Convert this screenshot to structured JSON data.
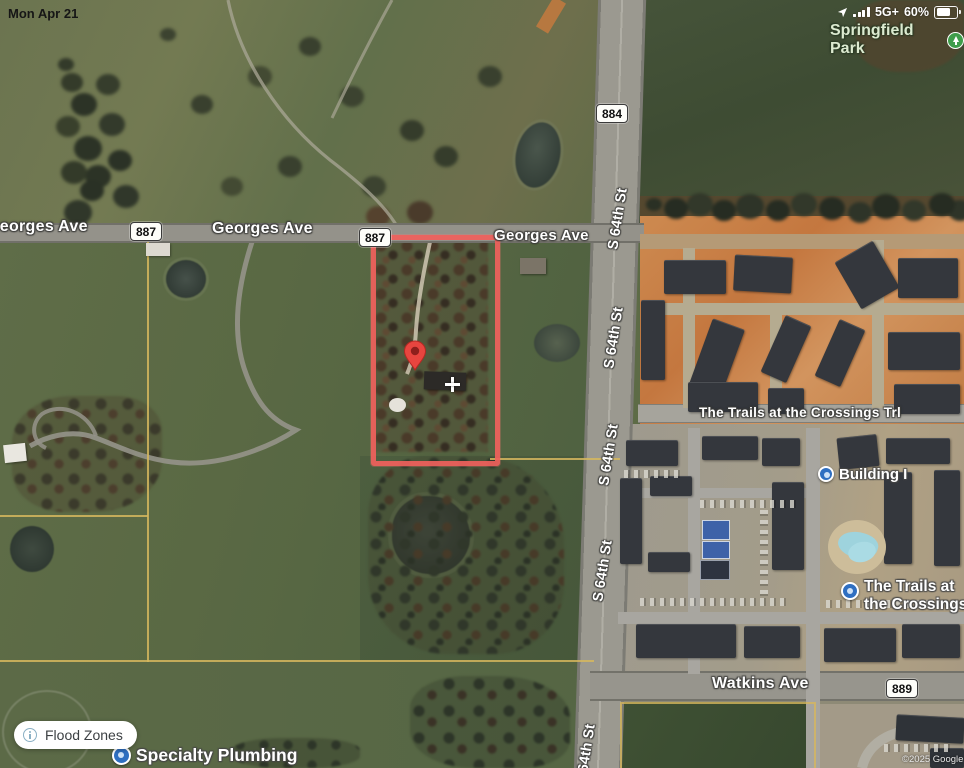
{
  "status_bar": {
    "date": "Mon Apr 21",
    "network": "5G+",
    "battery_percent": "60%"
  },
  "map": {
    "view_type": "satellite",
    "labels": {
      "park": "Springfield Park",
      "georges_ave": "Georges Ave",
      "s64th_st": "S 64th St",
      "watkins_ave": "Watkins Ave",
      "trails_trl": "The Trails at the Crossings Trl",
      "building_i": "Building I",
      "trails_poi_line1": "The Trails at",
      "trails_poi_line2": "the Crossings",
      "specialty_plumbing": "Specialty Plumbing"
    },
    "shields": {
      "route_884": "884",
      "route_887": "887",
      "route_889": "889"
    },
    "parcel": {
      "outline_color": "#f0615c",
      "marker_color": "#e8413c"
    },
    "colors": {
      "field_green": "#5d6b46",
      "dark_green": "#43513",
      "construction_orange": "#c77c44",
      "building_gray": "#34373d",
      "road_gray": "#94928a",
      "parcel_line_tan": "#d6b75e",
      "poi_blue": "#2f6fc1",
      "park_icon_green": "#3f9d4b",
      "park_text_green": "#dcead0"
    },
    "attribution": "©2025 Google"
  },
  "controls": {
    "flood_zones_label": "Flood Zones"
  }
}
